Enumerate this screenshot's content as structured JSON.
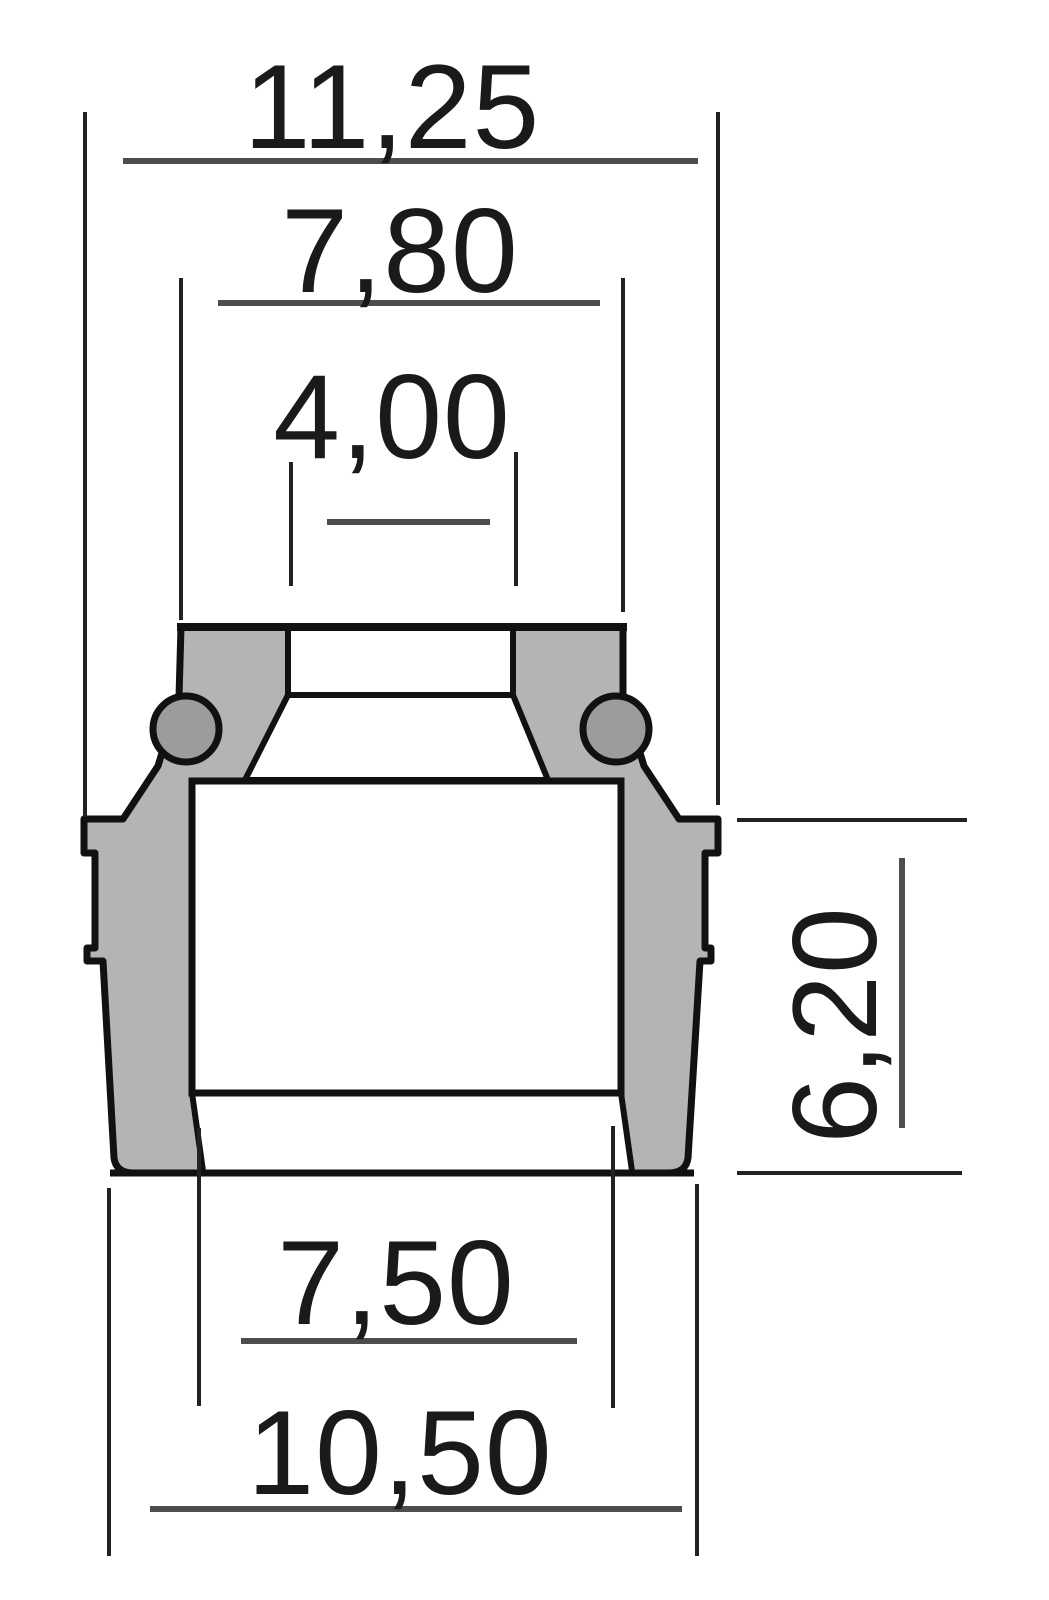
{
  "drawing": {
    "description": "Valve stem seal cross-section technical drawing with dimension callouts",
    "dimensions": {
      "top_outer_width": "11,25",
      "upper_body_width": "7,80",
      "bore_inner_diameter": "4,00",
      "lower_body_height": "6,20",
      "bottom_inner_diameter": "7,50",
      "bottom_outer_diameter": "10,50"
    },
    "colors": {
      "background": "#ffffff",
      "body_fill": "#b4b4b4",
      "spring_fill": "#9c9c9c",
      "interior_fill": "#ffffff",
      "outline": "#111111",
      "dimension_line": "#4d4d4d",
      "extension_line": "#222222",
      "text": "#1a1a1a"
    }
  }
}
